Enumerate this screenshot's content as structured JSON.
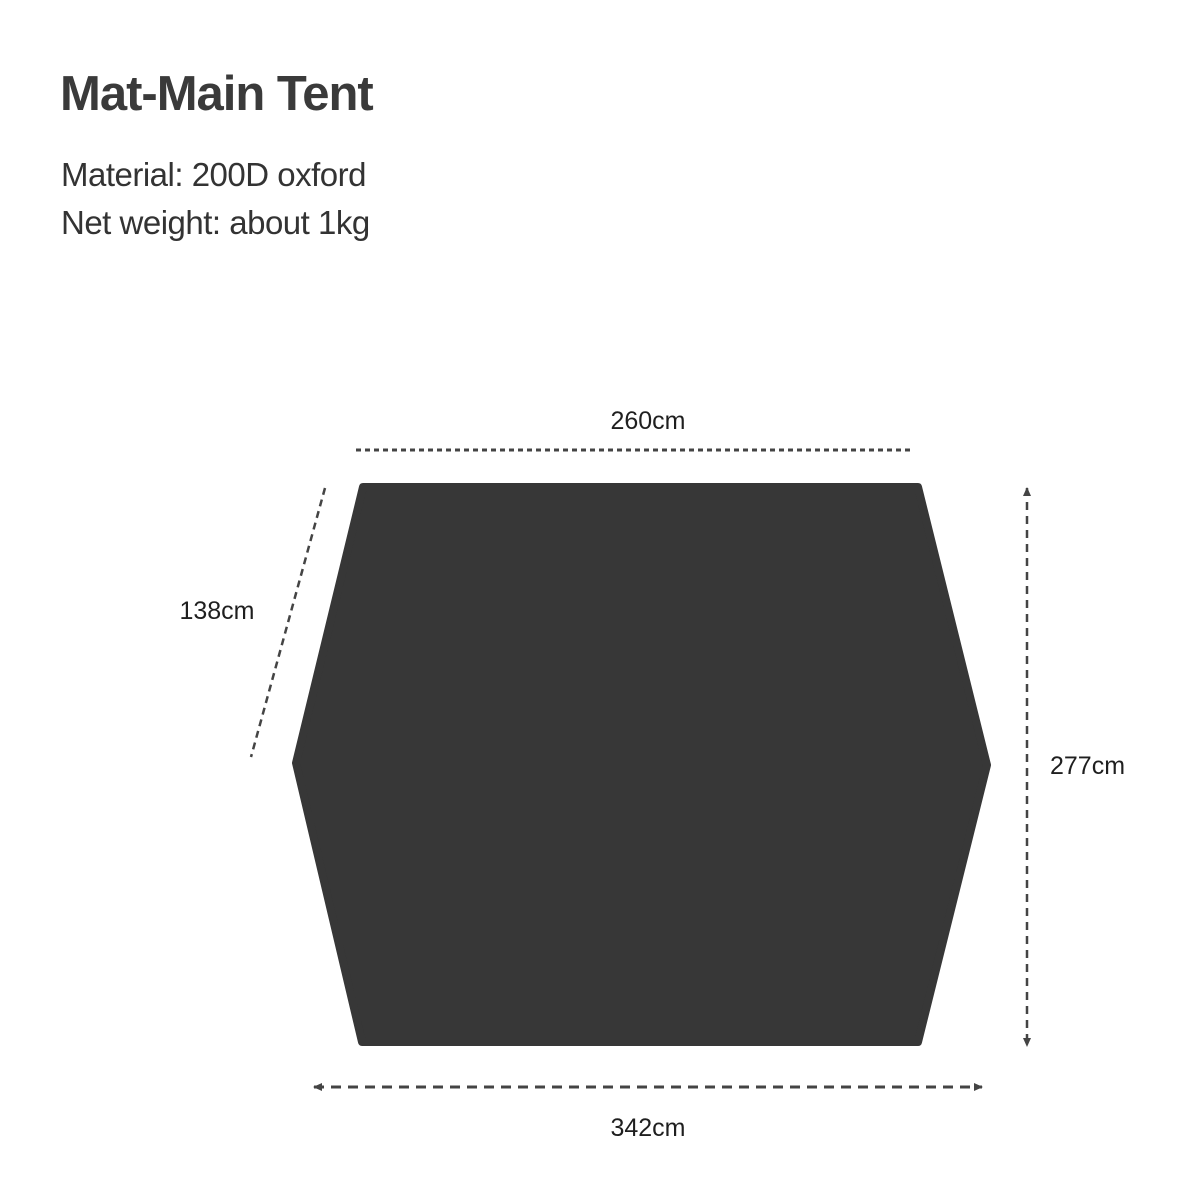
{
  "header": {
    "title": "Mat-Main Tent",
    "material": "Material: 200D oxford",
    "net_weight": "Net weight: about 1kg"
  },
  "diagram": {
    "dimensions": {
      "top_width": "260cm",
      "left_slant": "138cm",
      "right_height": "277cm",
      "bottom_width": "342cm"
    }
  },
  "colors": {
    "background": "#ffffff",
    "mat_fill": "#373737",
    "dim_line": "#444444",
    "label_color": "#1f1f1f",
    "title_color": "#3a3a3a",
    "spec_color": "#333333"
  }
}
